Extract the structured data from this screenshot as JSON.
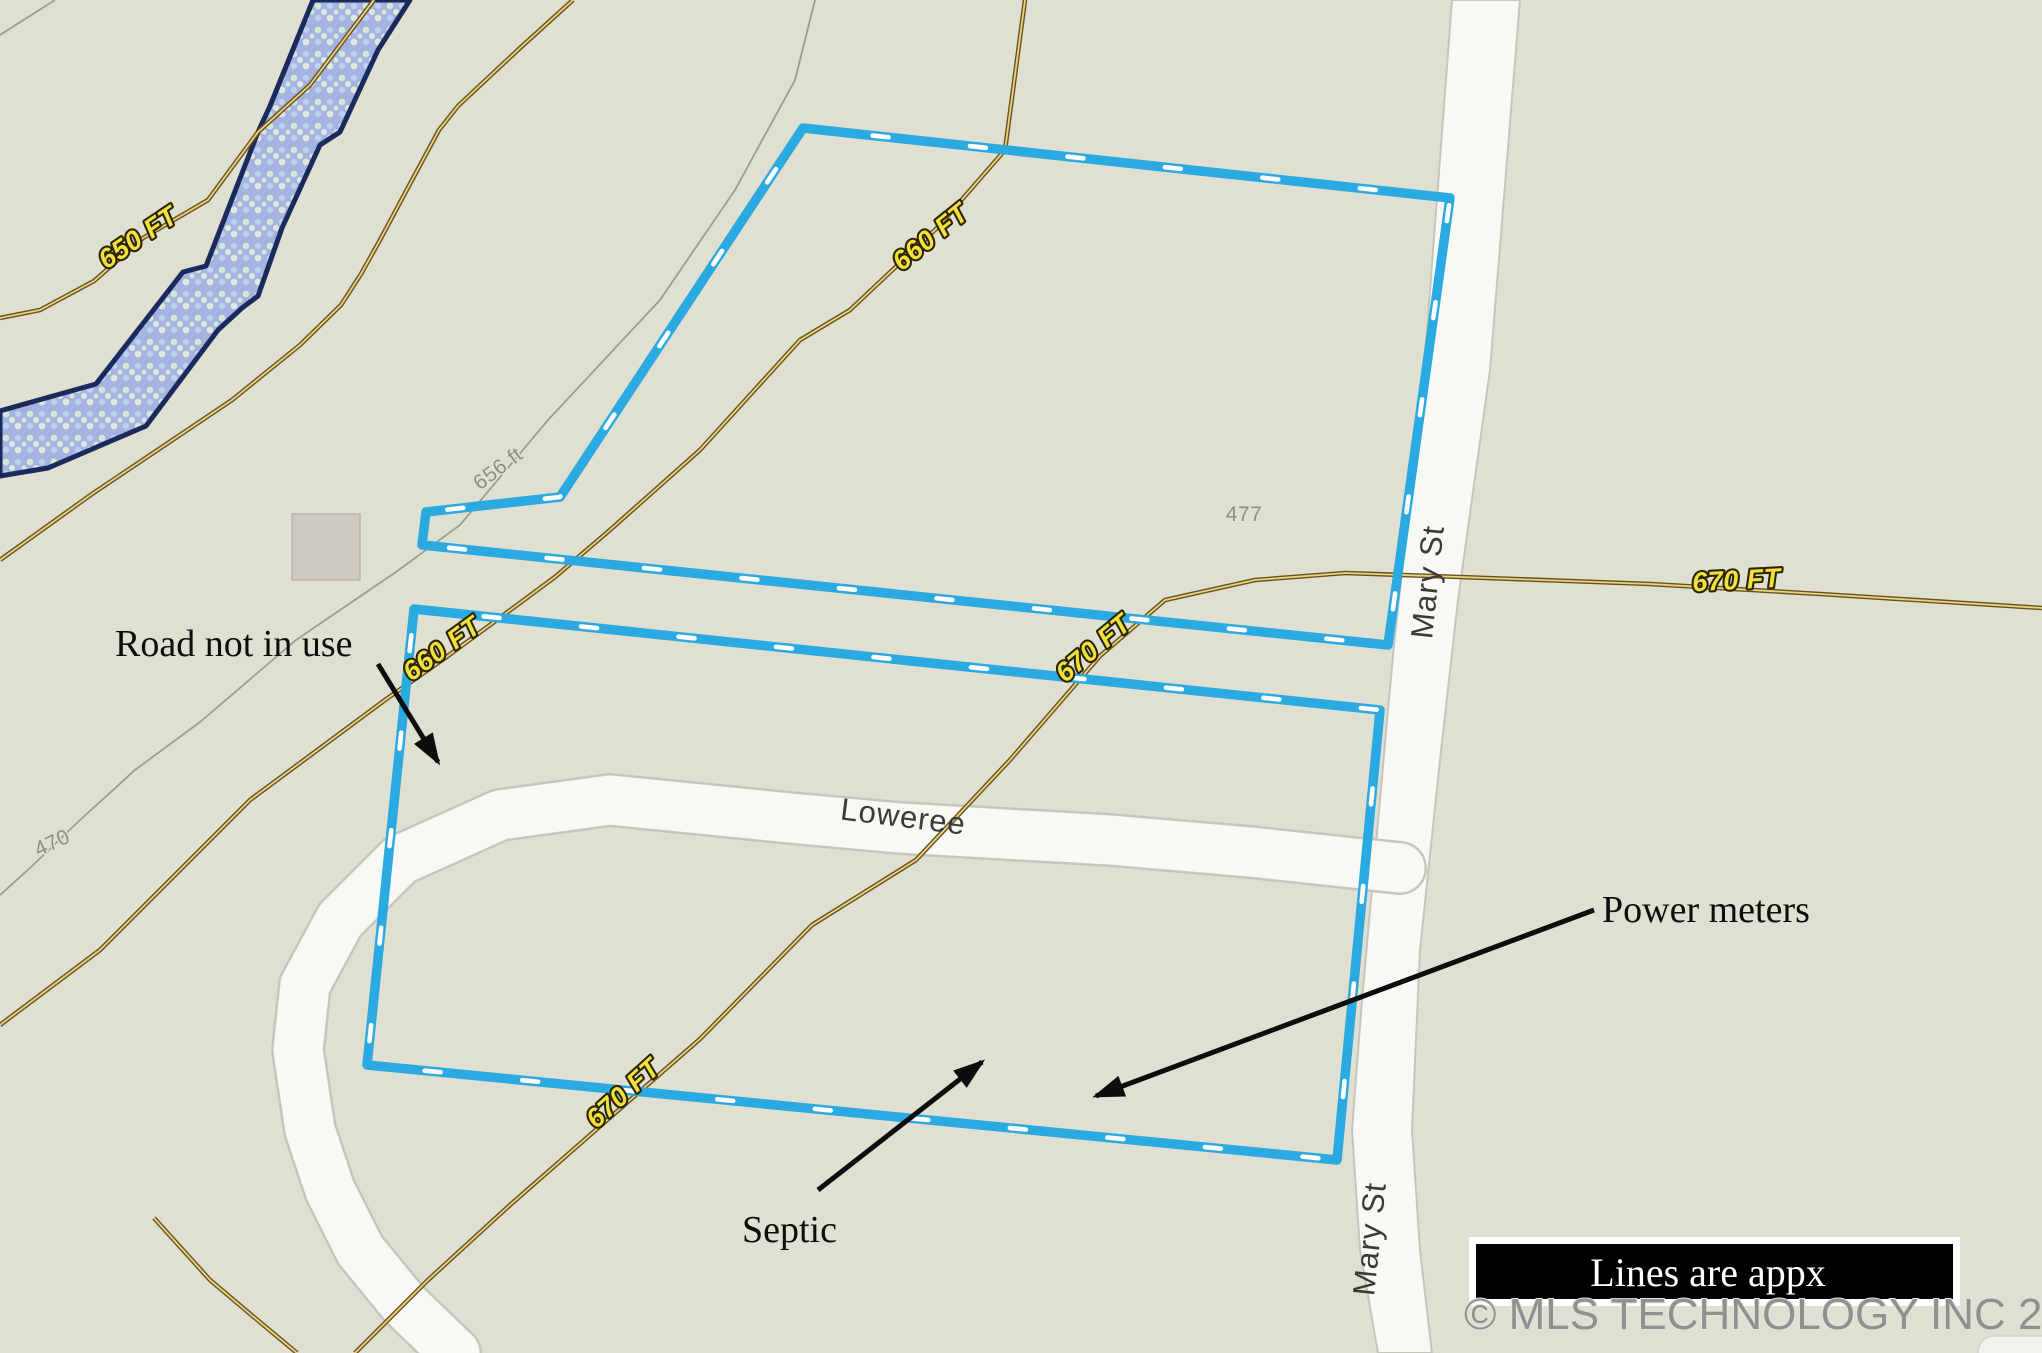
{
  "map": {
    "colors": {
      "bg": "#dfe0d1",
      "parcel_blue": "#2ba9e1",
      "dash_white": "#ffffff",
      "river_fill": "#a4b3e2",
      "river_border": "#1b2a5c",
      "river_dot_green": "#d2e8d2",
      "river_dot_blue": "#b9d3f0",
      "river_dot_cream": "#dfe8da",
      "contour_brown_dark": "#6b521c",
      "contour_brown_light": "#e6d386",
      "contour_label_fill": "#f3e13b",
      "contour_label_outline": "#2a2400",
      "gray_line": "#9c9c94",
      "gray_label": "#8e8e86",
      "road_fill": "#f8f8f5",
      "road_edge": "#c6c6be",
      "building_fill": "#ccc9c1",
      "building_edge": "#b9b6ae",
      "annotation_black": "#0d0d0d",
      "legend_bg": "#000000",
      "legend_border": "#ffffff",
      "legend_text": "#ffffff",
      "watermark_gray": "#8f918e",
      "watermark_halo": "#e3e3dd",
      "pill_fill": "#f2f3ee",
      "pill_edge": "#d2d3cb"
    },
    "contour_labels": [
      {
        "text": "650 FT"
      },
      {
        "text": "660 FT"
      },
      {
        "text": "660 FT"
      },
      {
        "text": "670 FT"
      },
      {
        "text": "670 FT"
      },
      {
        "text": "670 FT"
      }
    ],
    "road_labels": [
      {
        "text": "Mary St"
      },
      {
        "text": "Mary St"
      },
      {
        "text": "Loweree"
      }
    ],
    "elevation_labels": [
      {
        "text": "656 ft"
      },
      {
        "text": "470"
      },
      {
        "text": "477"
      }
    ],
    "annotations": [
      {
        "text": "Road not in use"
      },
      {
        "text": "Power meters"
      },
      {
        "text": "Septic"
      }
    ],
    "legend": {
      "text": "Lines are appx"
    },
    "watermark": {
      "text": "© MLS TECHNOLOGY INC 2025"
    }
  }
}
